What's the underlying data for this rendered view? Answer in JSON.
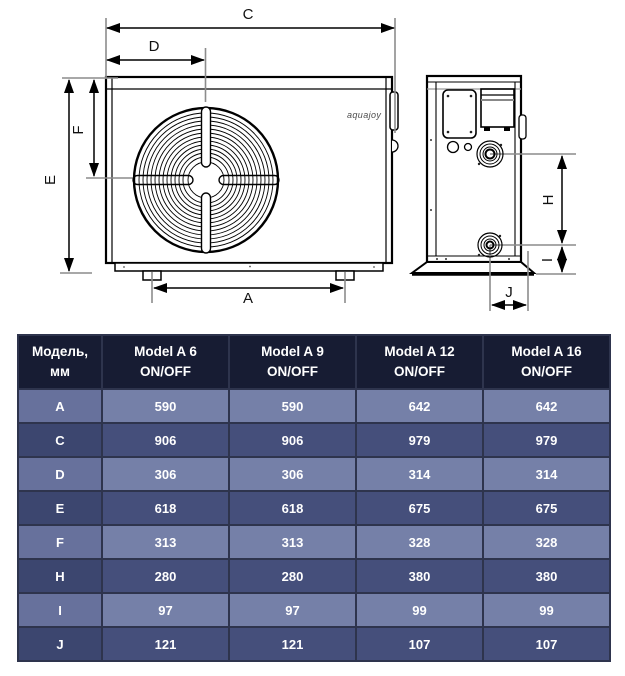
{
  "diagram": {
    "brand": "aquajoy",
    "dim_labels": {
      "a": "A",
      "c": "C",
      "d": "D",
      "e": "E",
      "f": "F",
      "h": "H",
      "i": "I",
      "j": "J"
    }
  },
  "table": {
    "col_headers": [
      "Модель,\nмм",
      "Model A 6\nON/OFF",
      "Model A 9\nON/OFF",
      "Model A 12\nON/OFF",
      "Model A 16\nON/OFF"
    ],
    "rows": [
      {
        "label": "A",
        "values": [
          "590",
          "590",
          "642",
          "642"
        ]
      },
      {
        "label": "C",
        "values": [
          "906",
          "906",
          "979",
          "979"
        ]
      },
      {
        "label": "D",
        "values": [
          "306",
          "306",
          "314",
          "314"
        ]
      },
      {
        "label": "E",
        "values": [
          "618",
          "618",
          "675",
          "675"
        ]
      },
      {
        "label": "F",
        "values": [
          "313",
          "313",
          "328",
          "328"
        ]
      },
      {
        "label": "H",
        "values": [
          "280",
          "280",
          "380",
          "380"
        ]
      },
      {
        "label": "I",
        "values": [
          "97",
          "97",
          "99",
          "99"
        ]
      },
      {
        "label": "J",
        "values": [
          "121",
          "121",
          "107",
          "107"
        ]
      }
    ]
  }
}
